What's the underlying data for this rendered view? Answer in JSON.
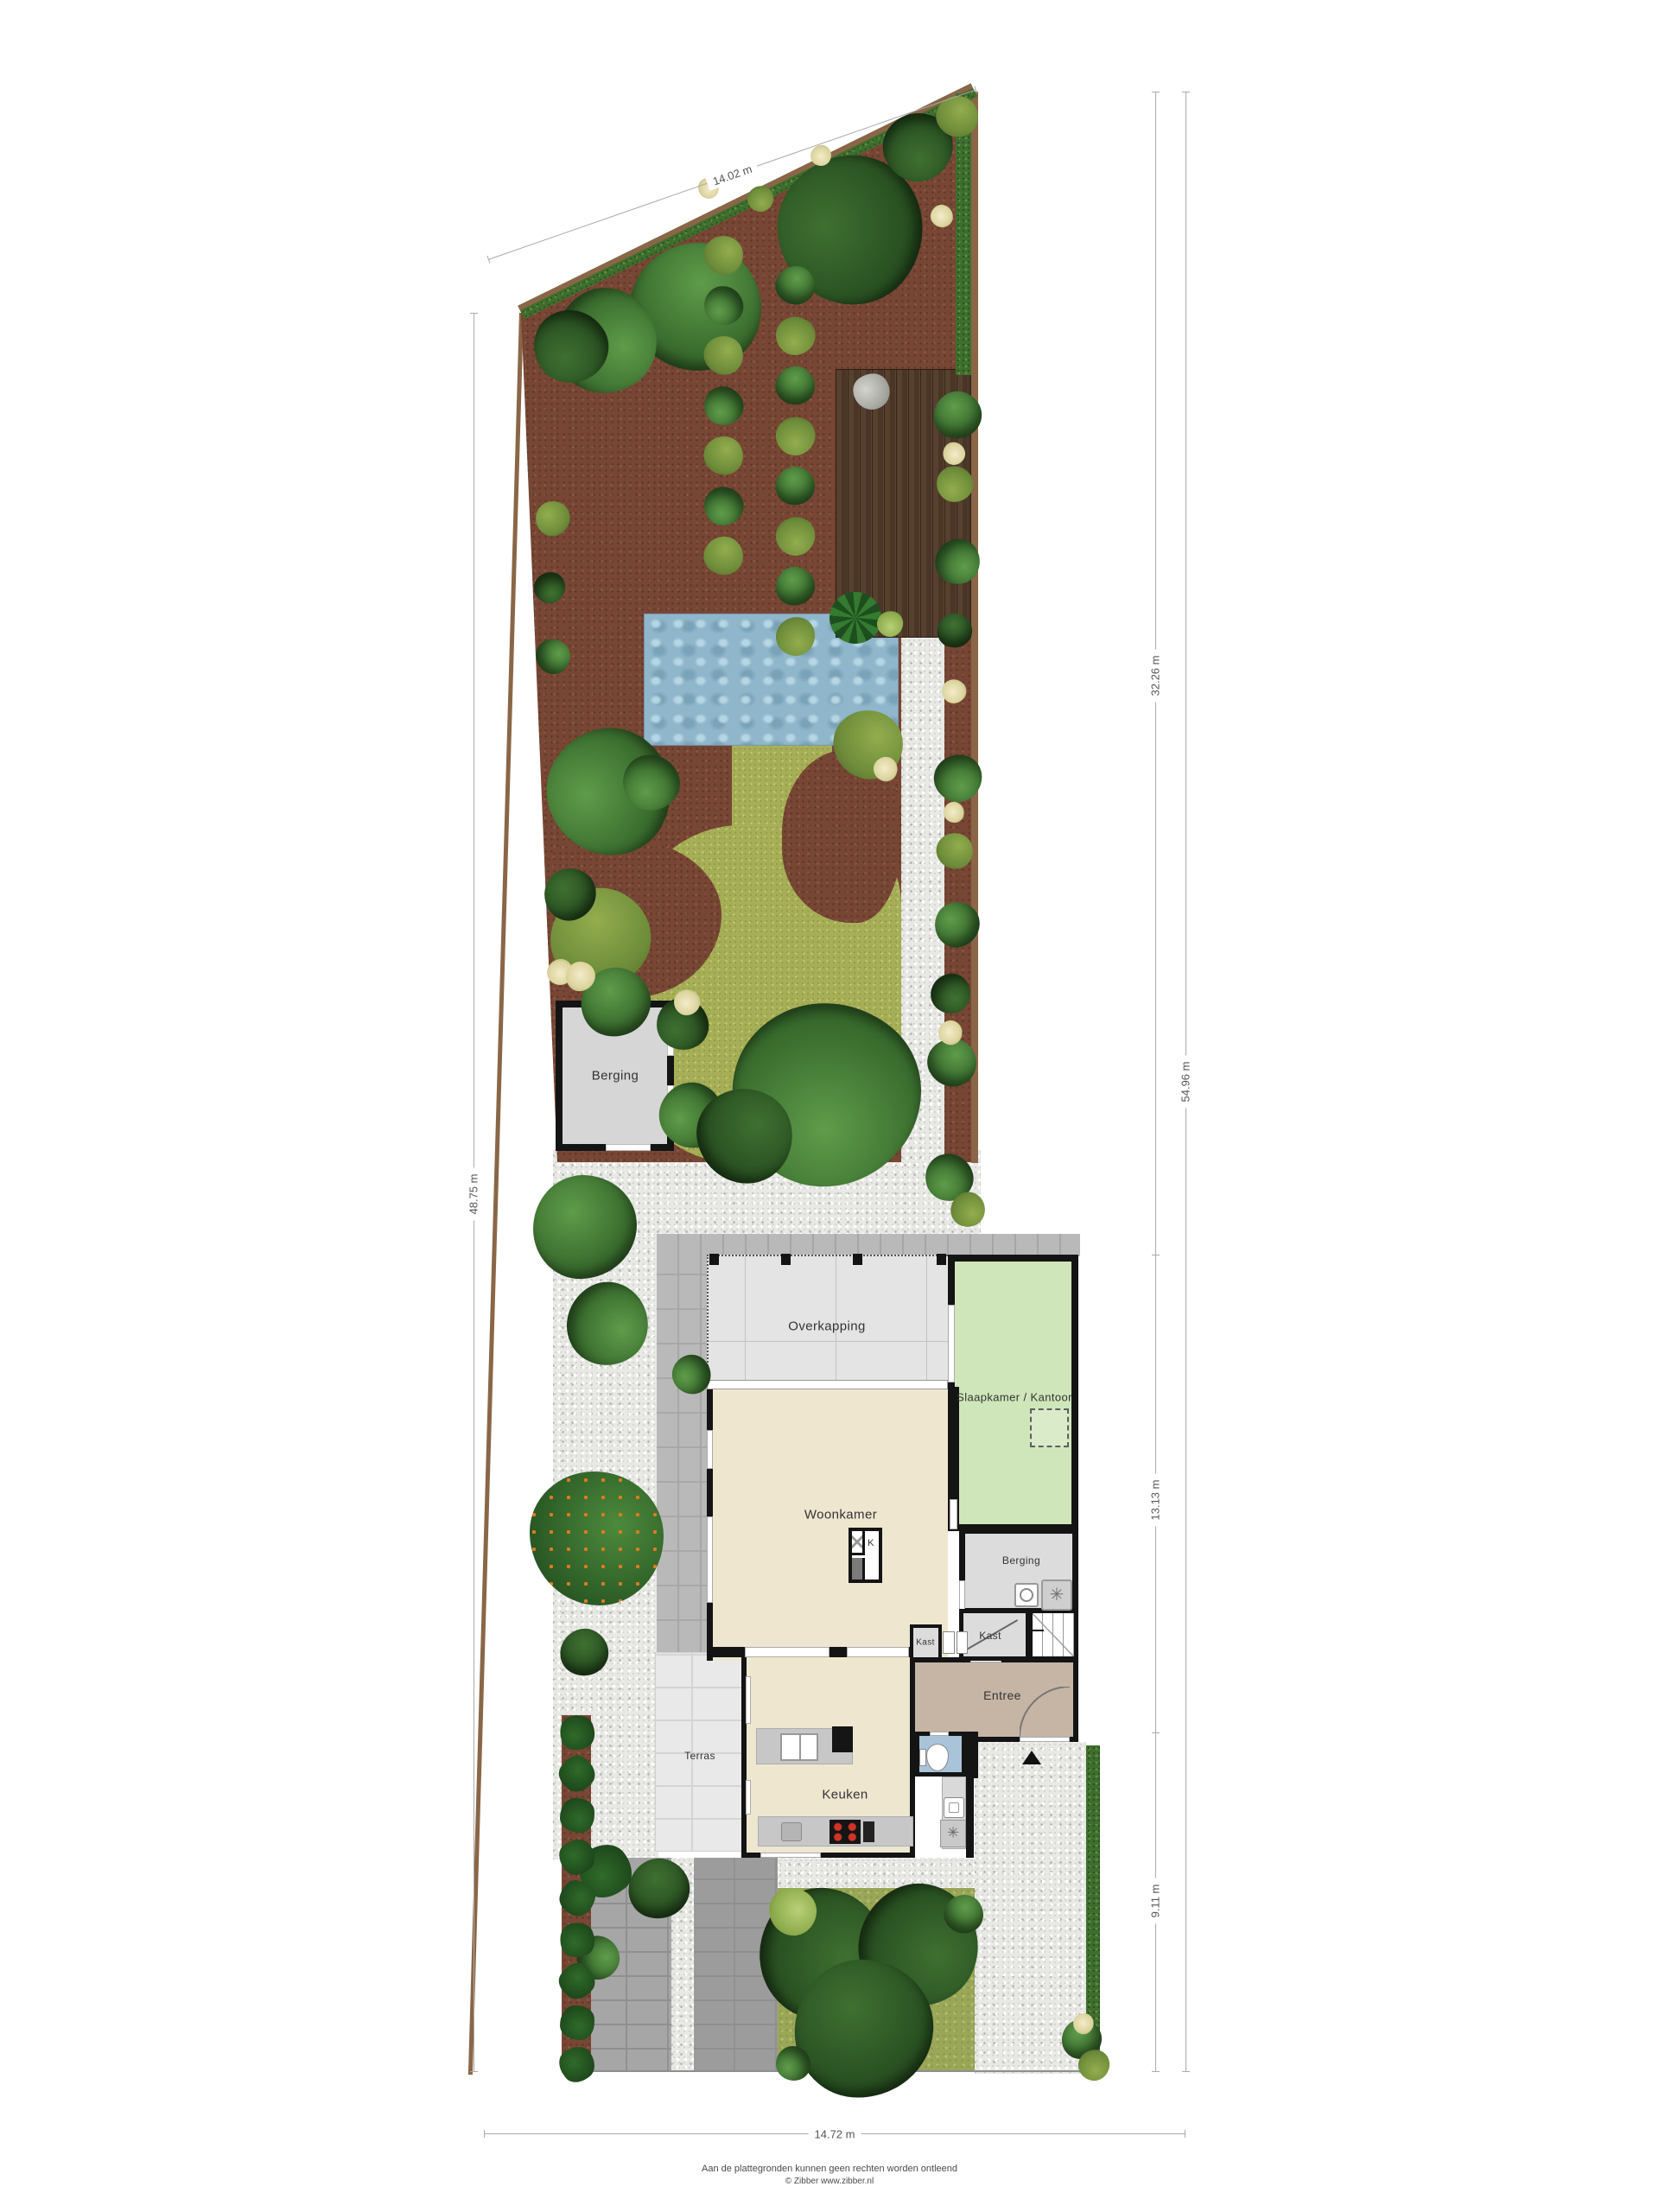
{
  "palette": {
    "mulch": "#774634",
    "lawn": "#a6ae57",
    "gravel": "#e8e8e5",
    "hedge": "#3e6e2e",
    "water": "#8fb6cb",
    "deck": "#4a3527",
    "floor_living": "#eee6cf",
    "floor_bedroom": "#cfe6ba",
    "floor_entry": "#c6b5a5",
    "wall": "#141414"
  },
  "dimensions": {
    "top": "14.02 m",
    "left": "48.75 m",
    "right_total": "54.96 m",
    "right_upper": "32.26 m",
    "right_middle": "13.13 m",
    "right_lower": "9.11 m",
    "bottom": "14.72 m"
  },
  "garden": {
    "shed": "Berging"
  },
  "rooms": {
    "overkapping": "Overkapping",
    "slaapkamer": "Slaapkamer / Kantoor",
    "woonkamer": "Woonkamer",
    "berging": "Berging",
    "kast_left": "Kast",
    "kast_right": "Kast",
    "entree": "Entree",
    "keuken": "Keuken",
    "terras": "Terras",
    "fireplace": "K"
  },
  "footer": {
    "disclaimer": "Aan de plattegronden kunnen geen rechten worden ontleend",
    "credit": "© Zibber www.zibber.nl"
  }
}
